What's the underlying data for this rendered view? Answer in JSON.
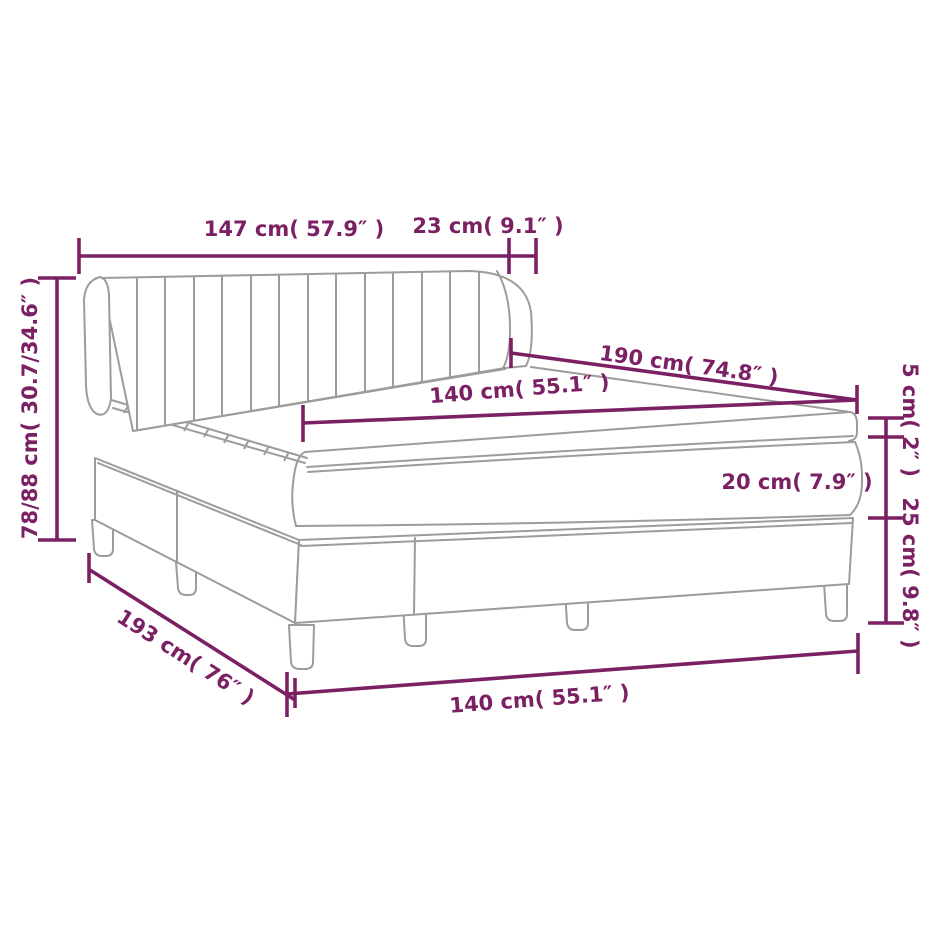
{
  "title": "Box spring bed with headboard — dimension diagram",
  "colors": {
    "dimension_accent": "#7c2064",
    "product_outline": "#9c9c9c",
    "background": "#ffffff"
  },
  "labels": {
    "headboard_width": "147 cm( 57.9″ )",
    "headboard_depth": "23 cm( 9.1″ )",
    "headboard_height": "78/88 cm( 30.7/34.6″ )",
    "bed_length": "190 cm( 74.8″ )",
    "mattress_width": "140 cm( 55.1″ )",
    "topper_thickness": "5 cm( 2″ )",
    "mattress_thickness": "20 cm( 7.9″ )",
    "base_height": "25 cm( 9.8″ )",
    "total_length": "193 cm( 76″ )",
    "base_width": "140 cm( 55.1″ )"
  }
}
